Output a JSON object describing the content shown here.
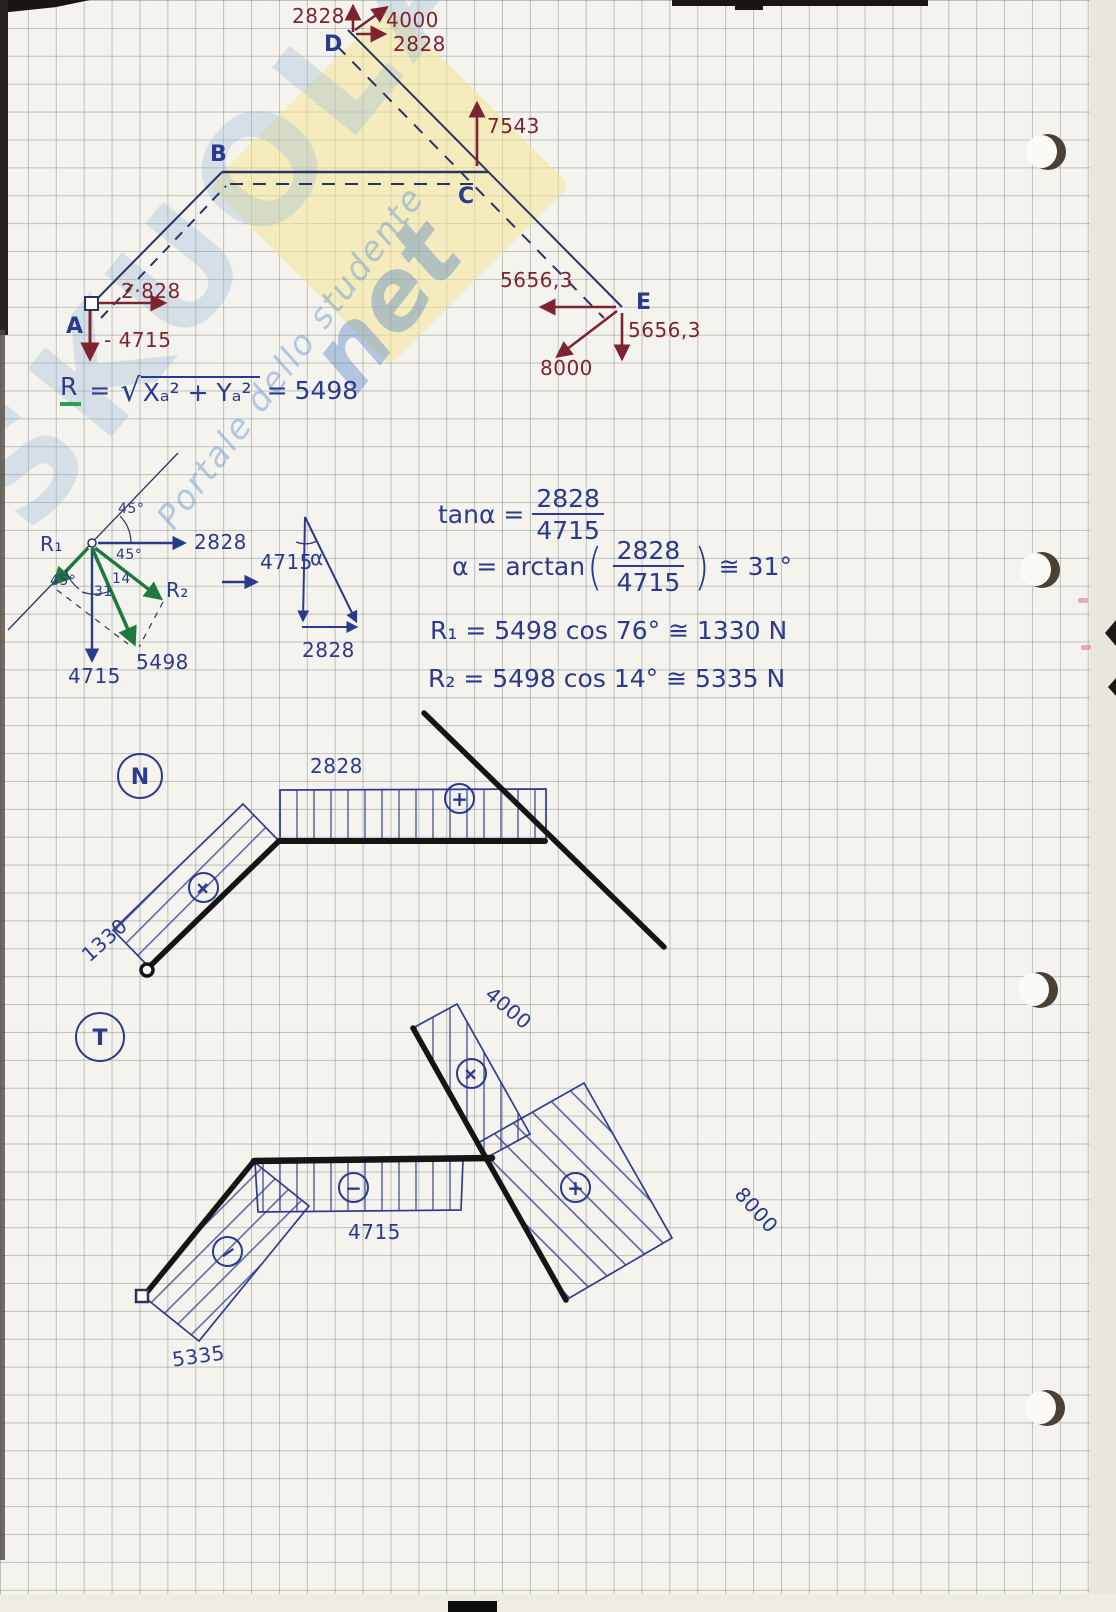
{
  "colors": {
    "ink_blue": "#2b3a8c",
    "ink_red": "#7e2430",
    "ink_green": "#1e7a3c",
    "ink_black": "#1a1a1a",
    "paper": "#f5f3ed"
  },
  "watermark": {
    "brand": "SKUOLA",
    "suffix": "net",
    "tagline": "Portale dello studente"
  },
  "frame": {
    "labels": {
      "a": "A",
      "b": "B",
      "c": "C",
      "d": "D",
      "e": "E"
    },
    "forces": {
      "d_up": "2828",
      "d_diag": "4000",
      "d_right": "2828",
      "c_up": "7543",
      "a_right": "2·828",
      "a_down": "- 4715",
      "e_left": "5656,3",
      "e_down": "5656,3",
      "e_diag": "8000"
    }
  },
  "resultant": {
    "lhs": "R",
    "eq": "=",
    "root": "√",
    "radicand": "Xₐ² + Yₐ²",
    "eq2": "=",
    "value": "5498"
  },
  "decomp": {
    "r1": "R₁",
    "r2": "R₂",
    "x_val": "2828",
    "y_val": "4715",
    "res_val": "5498",
    "ang_top": "45°",
    "ang_mid": "45°",
    "ang_left": "45°",
    "ang_31": "31",
    "ang_14": "14",
    "tri_v": "4715",
    "tri_a": "α",
    "tri_h": "2828"
  },
  "trig": {
    "tan_lhs": "tanα =",
    "tan_num": "2828",
    "tan_den": "4715",
    "arc_lhs": "α = arctan",
    "paren_l": "(",
    "arc_num": "2828",
    "arc_den": "4715",
    "paren_r": ")",
    "arc_rhs": "≅ 31°",
    "r1_line": "R₁ = 5498 cos 76° ≅ 1330 N",
    "r2_line": "R₂ = 5498 cos 14° ≅ 5335 N"
  },
  "n_diagram": {
    "title": "N",
    "top_band_value": "2828",
    "diag_band_value": "1330",
    "sign_top": "+",
    "sign_diag": "+"
  },
  "t_diagram": {
    "title": "T",
    "band_d": "4000",
    "sign_d": "+",
    "band_h": "4715",
    "sign_h": "−",
    "band_a": "5335",
    "sign_a": "−",
    "band_e": "8000",
    "sign_e": "+"
  }
}
